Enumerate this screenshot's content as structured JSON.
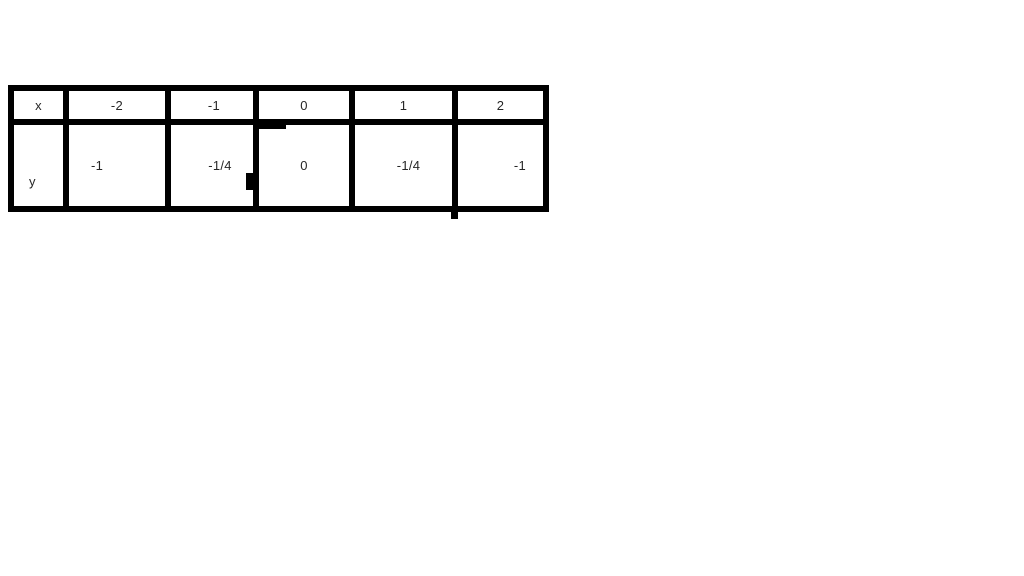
{
  "table": {
    "header": [
      "x",
      "-2",
      "-1",
      "0",
      "1",
      "2"
    ],
    "row": [
      "y",
      "-1",
      "-1/4",
      "0",
      "-1/4",
      "-1"
    ]
  },
  "chart_data": {
    "type": "table",
    "title": "",
    "columns": [
      "x",
      "-2",
      "-1",
      "0",
      "1",
      "2"
    ],
    "rows": [
      [
        "y",
        "-1",
        "-1/4",
        "0",
        "-1/4",
        "-1"
      ]
    ],
    "x_values": [
      -2,
      -1,
      0,
      1,
      2
    ],
    "y_values_text": [
      "-1",
      "-1/4",
      "0",
      "-1/4",
      "-1"
    ],
    "y_values_numeric": [
      -1,
      -0.25,
      0,
      -0.25,
      -1
    ]
  },
  "colors": {
    "background": "#ffffff",
    "grid_line": "#000000",
    "text": "#262626"
  }
}
